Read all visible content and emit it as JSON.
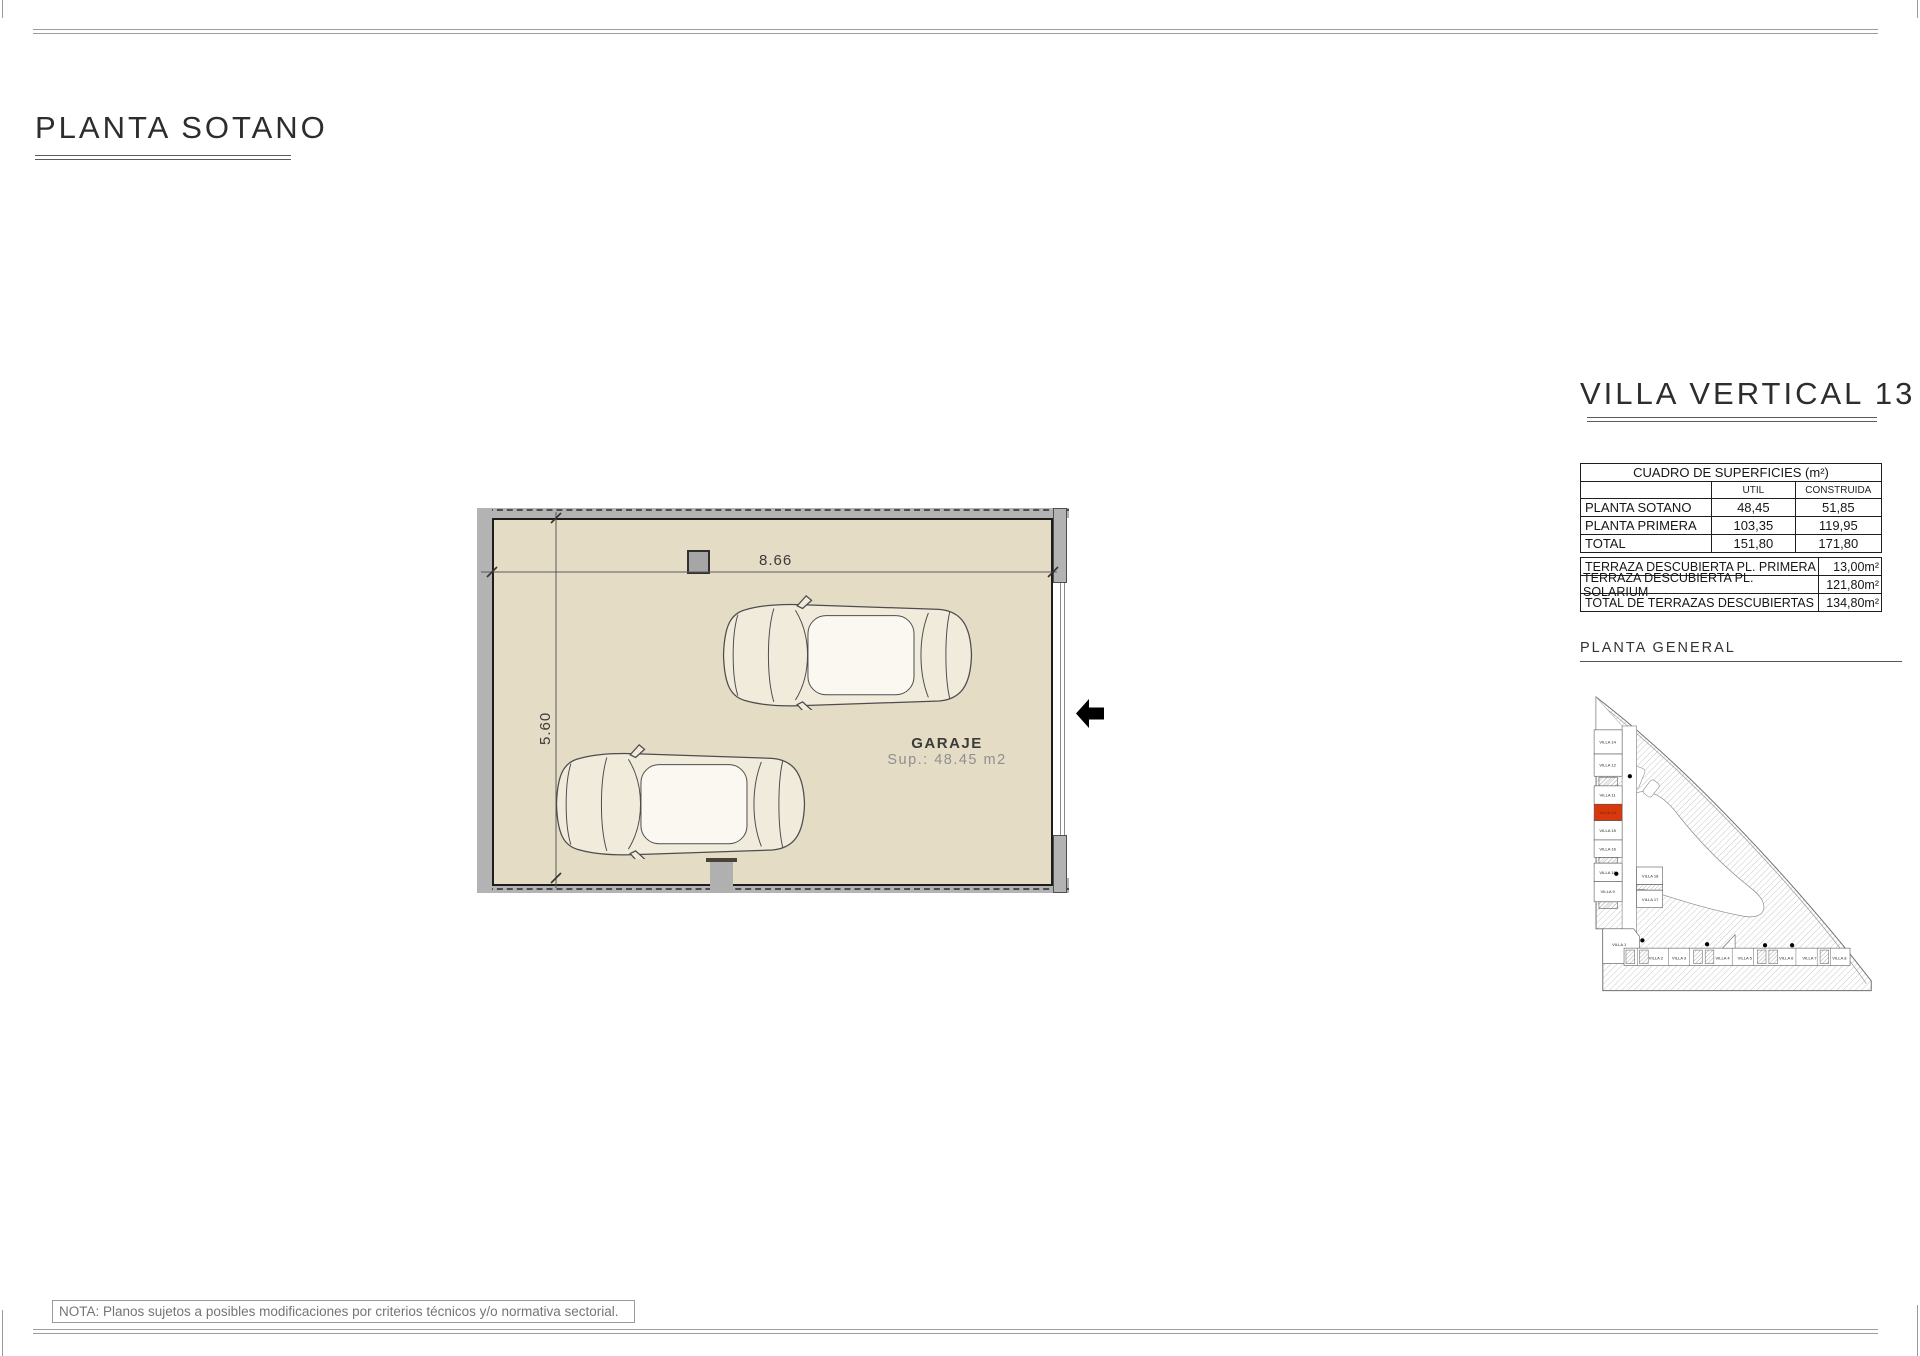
{
  "page": {
    "title": "PLANTA SOTANO",
    "note": "NOTA: Planos sujetos a posibles modificaciones por criterios técnicos y/o normativa sectorial."
  },
  "plan": {
    "room_label": "GARAJE",
    "room_area": "Sup.: 48.45 m2",
    "dim_width": "8.66",
    "dim_height": "5.60"
  },
  "panel": {
    "title": "VILLA VERTICAL 13",
    "surfaces_table": {
      "header": "CUADRO DE SUPERFICIES (m²)",
      "col_util": "UTIL",
      "col_construida": "CONSTRUIDA",
      "rows": [
        {
          "label": "PLANTA SOTANO",
          "util": "48,45",
          "construida": "51,85"
        },
        {
          "label": "PLANTA PRIMERA",
          "util": "103,35",
          "construida": "119,95"
        },
        {
          "label": "TOTAL",
          "util": "151,80",
          "construida": "171,80"
        }
      ]
    },
    "terraces_table": {
      "rows": [
        {
          "label": "TERRAZA DESCUBIERTA PL. PRIMERA",
          "value": "13,00m²"
        },
        {
          "label": "TERRAZA DESCUBIERTA PL. SOLARIUM",
          "value": "121,80m²"
        },
        {
          "label": "TOTAL DE TERRAZAS DESCUBIERTAS",
          "value": "134,80m²"
        }
      ]
    },
    "site_plan": {
      "label": "PLANTA  GENERAL",
      "highlighted_villa": "VILLA 13",
      "left_column": [
        "VILLA 14",
        "VILLA 12",
        "VILLA 11",
        "VILLA 13",
        "VILLA 15",
        "VILLA 16",
        "VILLA 10",
        "VILLA 9"
      ],
      "middle_column": [
        "VILLA 18",
        "VILLA 17"
      ],
      "bottom_row": [
        "VILLA 1",
        "VILLA 2",
        "VILLA 3",
        "VILLA 4",
        "VILLA 5",
        "VILLA 6",
        "VILLA 7",
        "VILLA 8"
      ]
    }
  },
  "colors": {
    "floor": "#e5dcc5",
    "wall": "#b3b3b3",
    "highlight": "#d8380e",
    "plan_line": "#4f4f4f"
  }
}
